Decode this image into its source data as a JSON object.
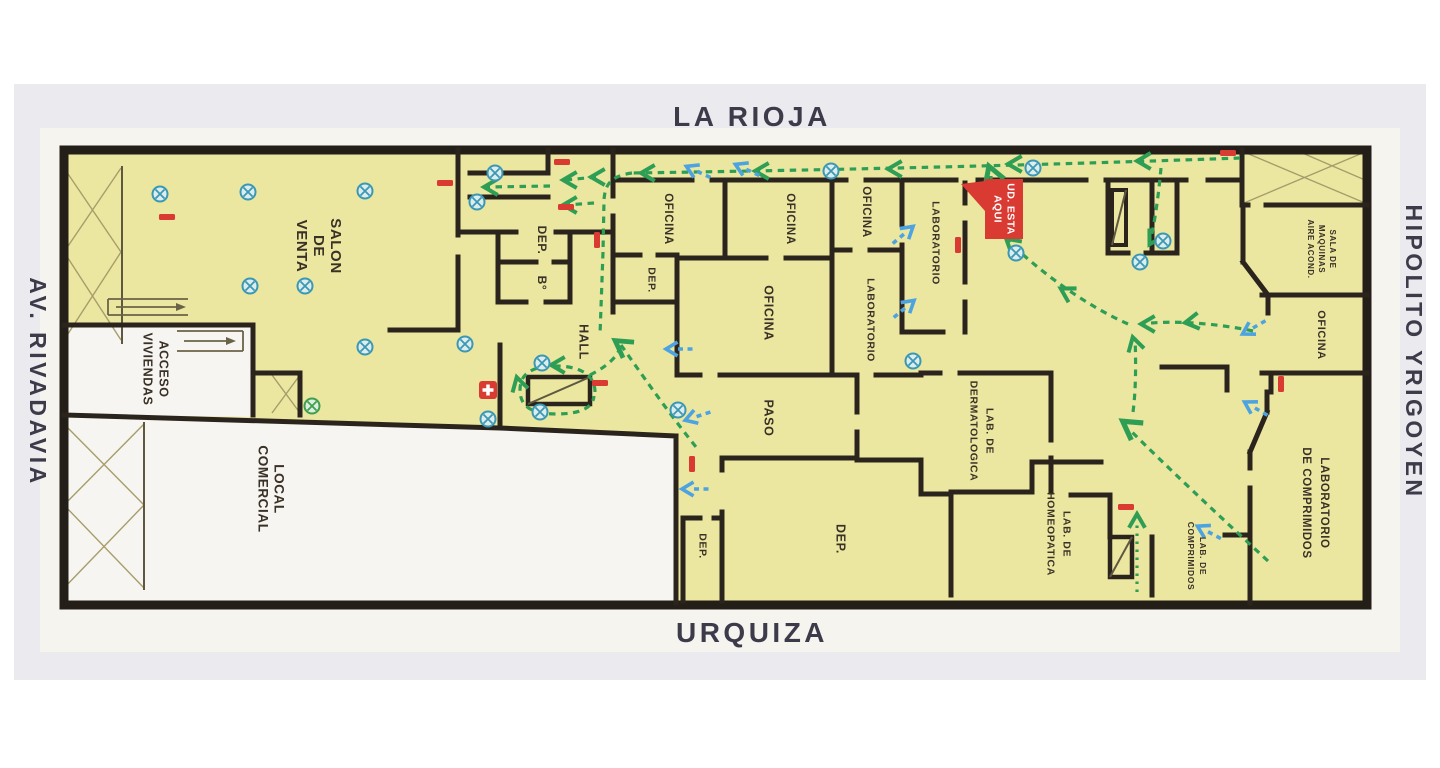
{
  "streets": {
    "top": "LA RIOJA",
    "bottom": "URQUIZA",
    "left": "AV. RIVADAVIA",
    "right": "HIPOLITO YRIGOYEN"
  },
  "you_are_here": {
    "line1": "UD. ESTA",
    "line2": "AQUI"
  },
  "rooms": {
    "salon_de_venta": {
      "l1": "SALON",
      "l2": "DE",
      "l3": "VENTA"
    },
    "acceso_viviendas": {
      "l1": "ACCESO",
      "l2": "VIVIENDAS"
    },
    "local_comercial": {
      "l1": "LOCAL",
      "l2": "COMERCIAL"
    },
    "dep_top": "DEP.",
    "banio": "B°",
    "hall": "HALL",
    "oficina_1": "OFICINA",
    "dep_mid": "DEP.",
    "oficina_2": "OFICINA",
    "oficina_central": "OFICINA",
    "oficina_3": "OFICINA",
    "laboratorio_1": "LABORATORIO",
    "laboratorio_2": "LABORATORIO",
    "paso": "PASO",
    "lab_dermatologica": {
      "l1": "LAB. DE",
      "l2": "DERMATOLOGICA"
    },
    "dep_grande": "DEP.",
    "dep_bajo": "DEP.",
    "lab_homeopatica": {
      "l1": "LAB. DE",
      "l2": "HOMEOPATICA"
    },
    "lab_comprimidos_chico": {
      "l1": "LAB. DE",
      "l2": "COMPRIMIDOS"
    },
    "laboratorio_comprimidos": {
      "l1": "LABORATORIO",
      "l2": "DE COMPRIMIDOS"
    },
    "oficina_derecha": "OFICINA",
    "sala_maquinas": {
      "l1": "SALA DE",
      "l2": "MAQUINAS",
      "l3": "AIRE ACOND."
    }
  },
  "legend": {
    "evacuation_route_color": "#2f9e55",
    "room_exit_arrow_color": "#4da3e0",
    "extinguisher_color": "#d93a32",
    "first_aid_color": "#d93a32",
    "emergency_light_symbol": "circle-x",
    "floor_fill": "#ebe7a1",
    "wall_color": "#2b241d"
  }
}
